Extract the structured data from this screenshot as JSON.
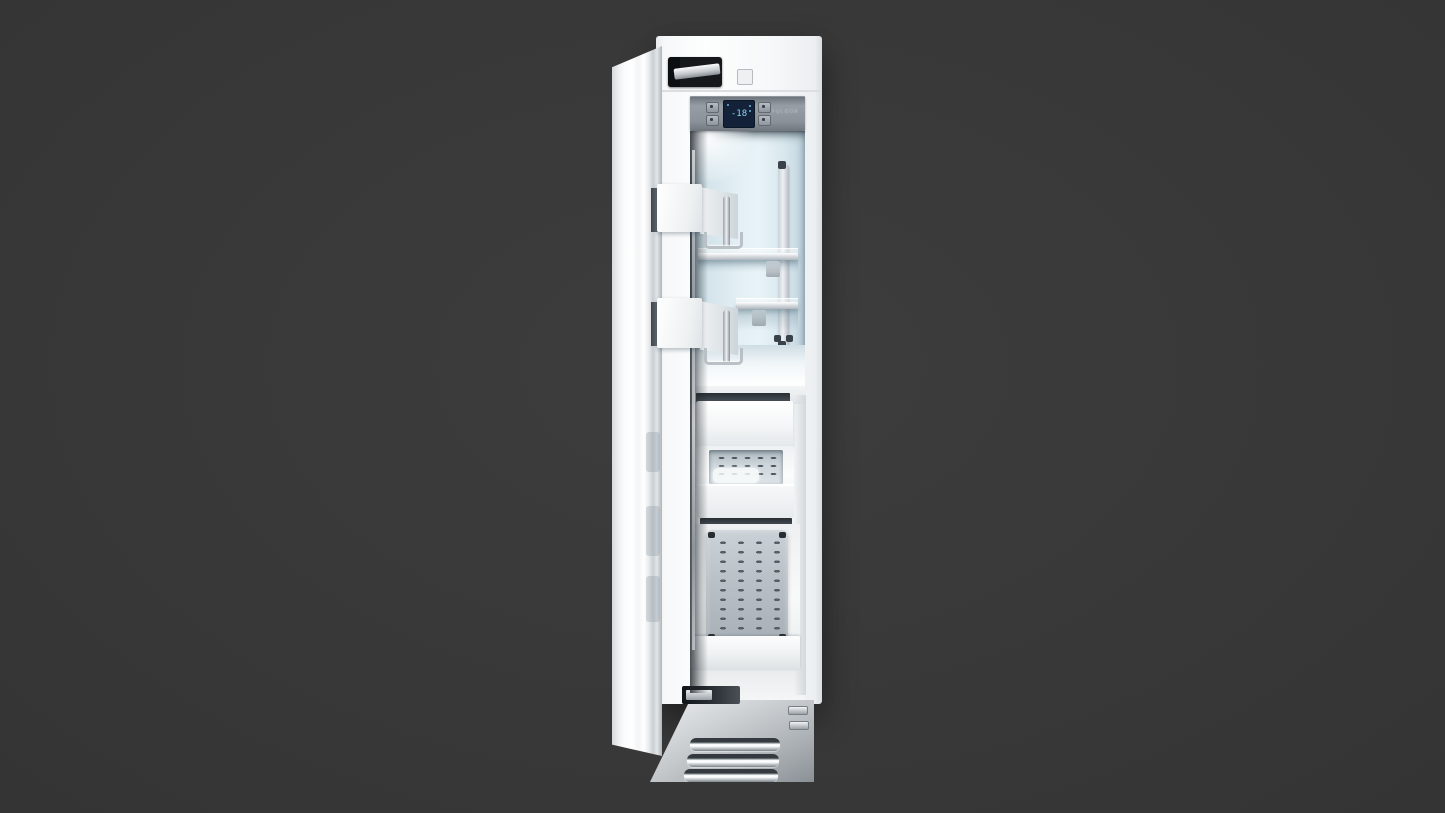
{
  "scene": {
    "type": "product-photo",
    "subject": "Built-in panel-ready column freezer with door open",
    "background_color": "#3a3a3a"
  },
  "freezer": {
    "finish_color": "#f5f6f7",
    "interior_color": "#dfedf3",
    "door": {
      "state": "open"
    },
    "control_panel": {
      "panel_color": "#8b929a",
      "brand_text": "FULGOR",
      "display": {
        "value": "-18",
        "text_color": "#8fd3f2",
        "screen_color": "#132239"
      },
      "button_count": 4
    },
    "upper_compartment": {
      "door_bins": 2,
      "glass_shelves": 2,
      "chrome_rail": 1
    },
    "lower_compartment": {
      "drawers": 2,
      "pull_out_basket": 1,
      "ice_tray_visible": true
    },
    "base_grille": {
      "slat_count": 5,
      "clip_count": 2,
      "finish_color": "#b7bdc2"
    }
  }
}
